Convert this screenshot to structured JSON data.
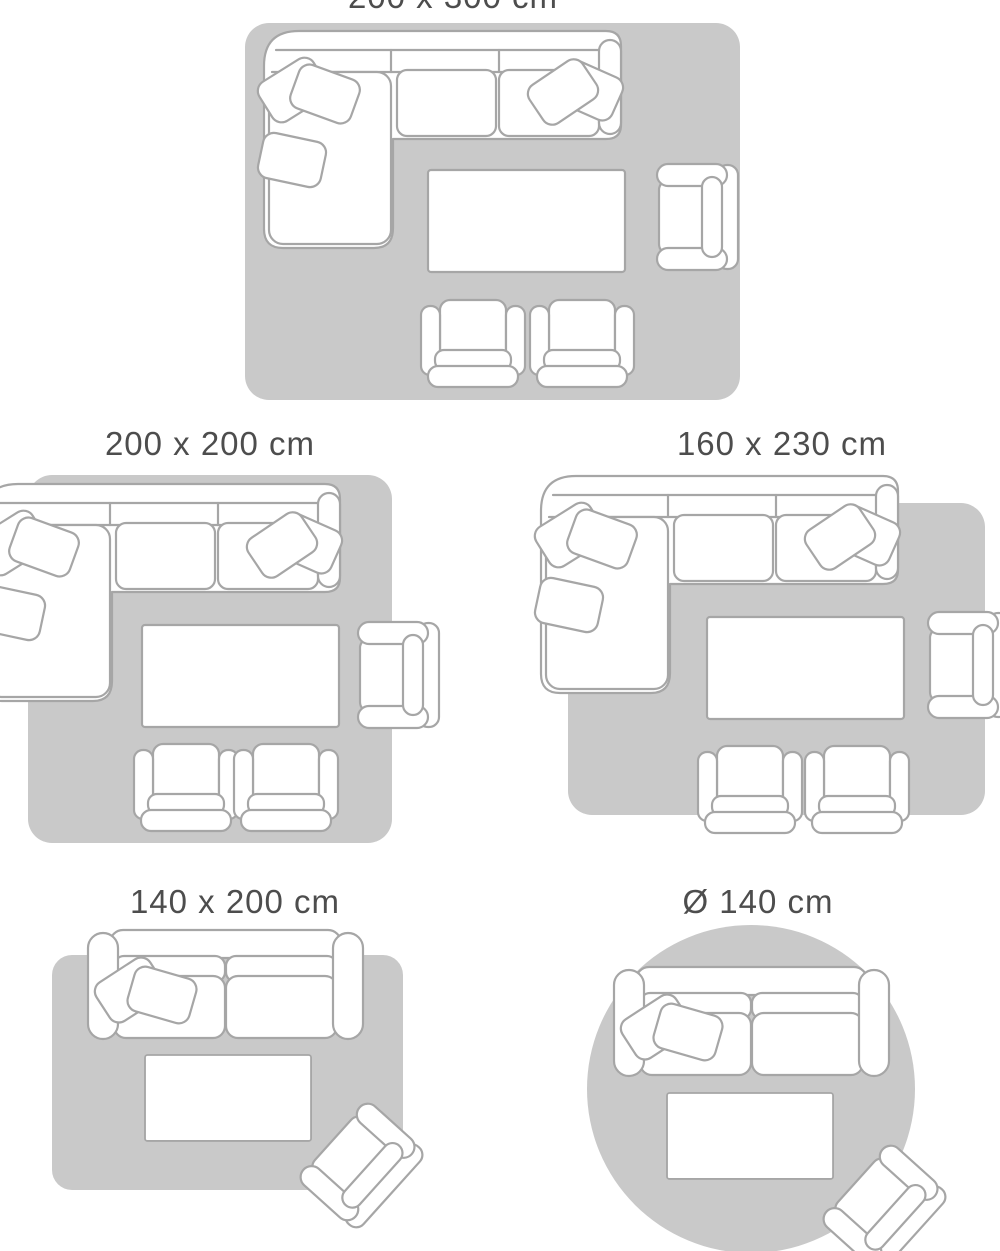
{
  "figures": [
    {
      "label": "200 x 300 cm",
      "label_cropped_at_top_edge": true,
      "rug_shape": "rounded-rectangle",
      "furniture": [
        "corner-sofa",
        "coffee-table",
        "armchair",
        "footstool-chair",
        "footstool-chair"
      ]
    },
    {
      "label": "200 x 200 cm",
      "rug_shape": "rounded-square",
      "furniture": [
        "corner-sofa",
        "coffee-table",
        "armchair",
        "footstool-chair",
        "footstool-chair"
      ]
    },
    {
      "label": "160 x 230 cm",
      "rug_shape": "rounded-rectangle",
      "furniture": [
        "corner-sofa",
        "coffee-table",
        "armchair",
        "footstool-chair",
        "footstool-chair"
      ]
    },
    {
      "label": "140 x 200 cm",
      "rug_shape": "rounded-rectangle",
      "furniture": [
        "two-seat-sofa",
        "coffee-table",
        "tilted-armchair"
      ]
    },
    {
      "label": "Ø 140 cm",
      "rug_shape": "circle",
      "furniture": [
        "two-seat-sofa",
        "coffee-table",
        "tilted-armchair"
      ]
    }
  ],
  "colors": {
    "background": "#ffffff",
    "rug_fill": "#c9c9c9",
    "furniture_fill": "#ffffff",
    "furniture_outline": "#a6a6a6",
    "label_text": "#4d4d4d"
  }
}
